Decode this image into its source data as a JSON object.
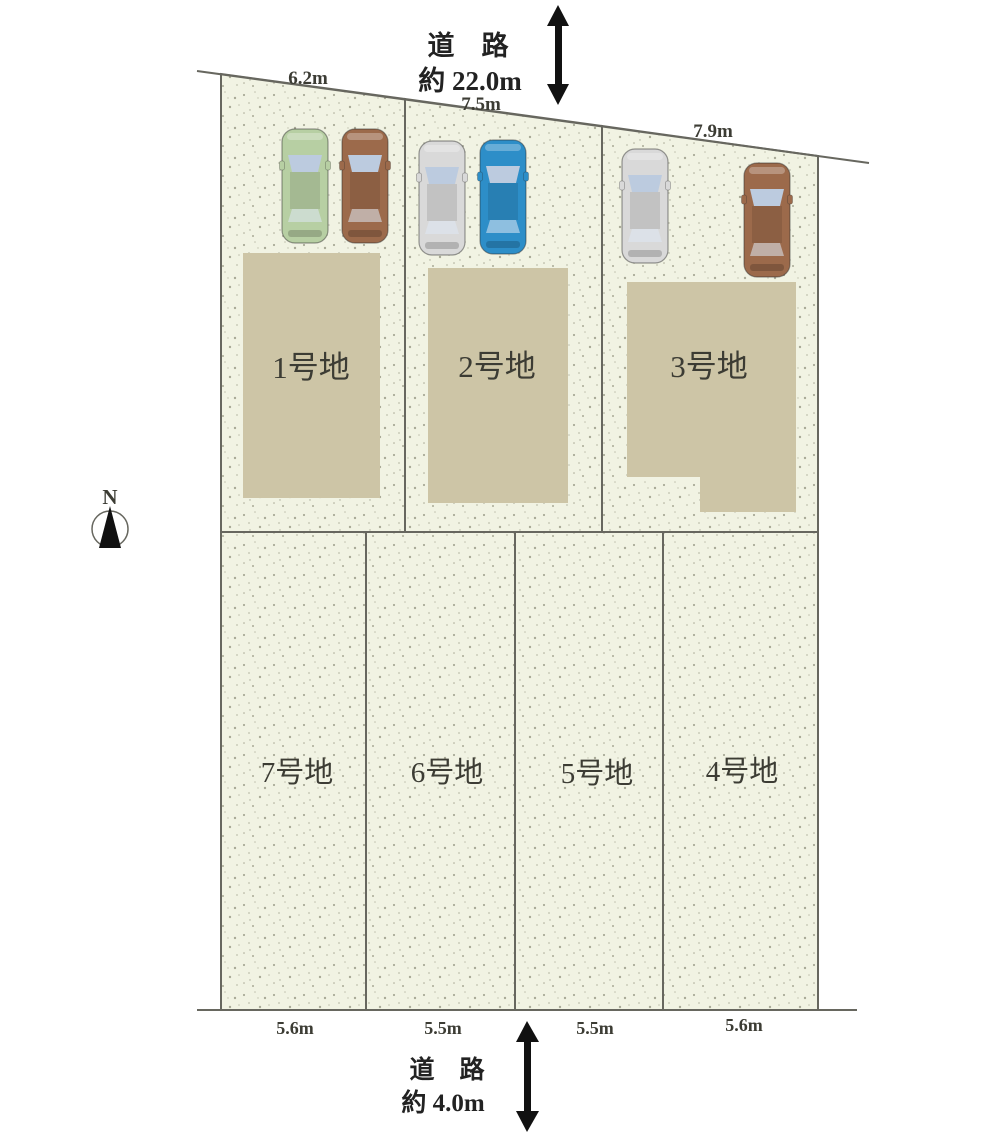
{
  "title": "区画図 (lot layout plan)",
  "colors": {
    "plot_fill": "#f1f3e3",
    "speckle_dark": "#83836f",
    "speckle_light": "#a5a591",
    "building": "#cdc5a6",
    "line": "#67675f",
    "text": "#3c3c34",
    "road_text": "#222222",
    "arrow": "#111111",
    "windshield": "#bccbdf"
  },
  "roads": {
    "top": {
      "label": "道　路",
      "width": "約 22.0m"
    },
    "bottom": {
      "label": "道　路",
      "width": "約 4.0m"
    }
  },
  "compass": {
    "label": "N"
  },
  "plots": [
    {
      "label": "1号地"
    },
    {
      "label": "2号地"
    },
    {
      "label": "3号地"
    },
    {
      "label": "4号地"
    },
    {
      "label": "5号地"
    },
    {
      "label": "6号地"
    },
    {
      "label": "7号地"
    }
  ],
  "dimensions": {
    "top": [
      "6.2m",
      "7.5m",
      "7.9m"
    ],
    "bottom": [
      "5.6m",
      "5.5m",
      "5.5m",
      "5.6m"
    ]
  },
  "cars": [
    {
      "name": "green car in plot 1",
      "color": "#b7cfa3"
    },
    {
      "name": "brown car in plot 1",
      "color": "#9c6a4b"
    },
    {
      "name": "white car in plot 2",
      "color": "#d9d9d9"
    },
    {
      "name": "blue car in plot 2",
      "color": "#2d8ec8"
    },
    {
      "name": "white car in plot 3",
      "color": "#d9d9d9"
    },
    {
      "name": "brown car in plot 3",
      "color": "#9c6a4b"
    }
  ]
}
